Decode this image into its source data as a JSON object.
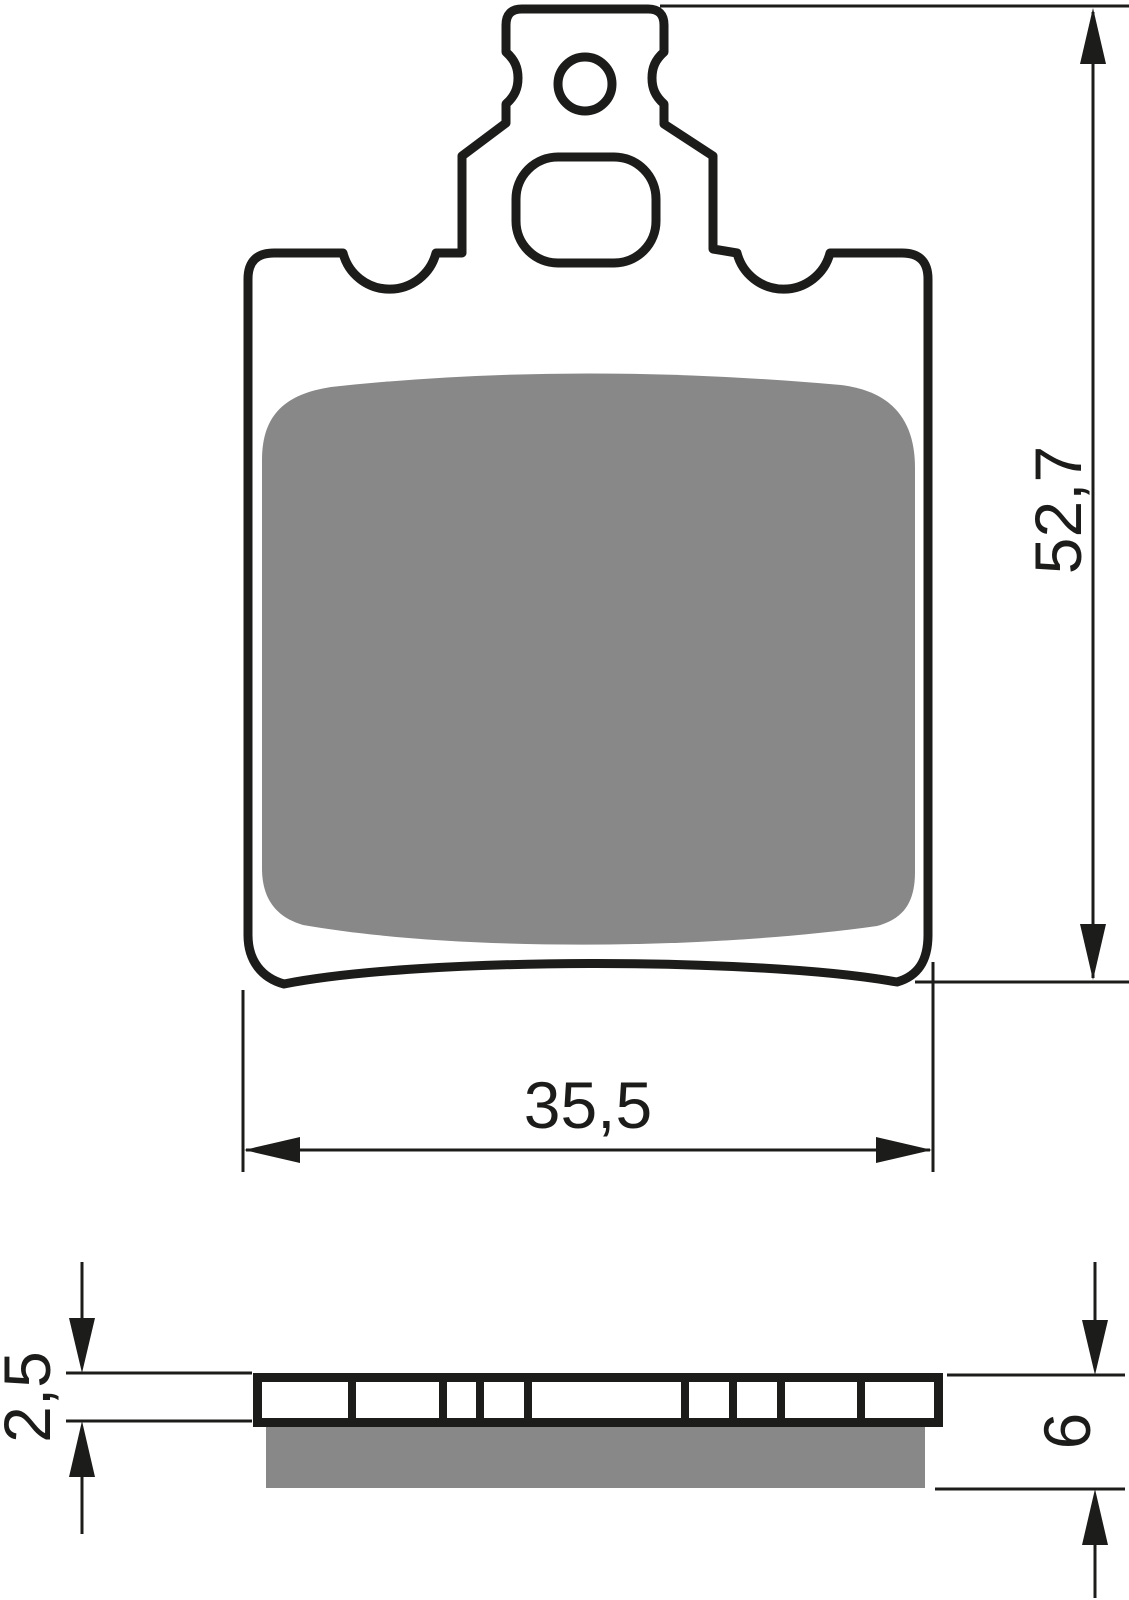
{
  "drawing": {
    "kind": "brake-pad-technical-drawing",
    "views": {
      "front": "pad-front-view",
      "side": "pad-side-view"
    }
  },
  "dimensions": {
    "overall_height": "52,7",
    "pad_width": "35,5",
    "backplate_thickness": "2,5",
    "total_thickness": "6"
  },
  "colors": {
    "line": "#1c1c1a",
    "friction": "#888888",
    "background": "#ffffff"
  }
}
